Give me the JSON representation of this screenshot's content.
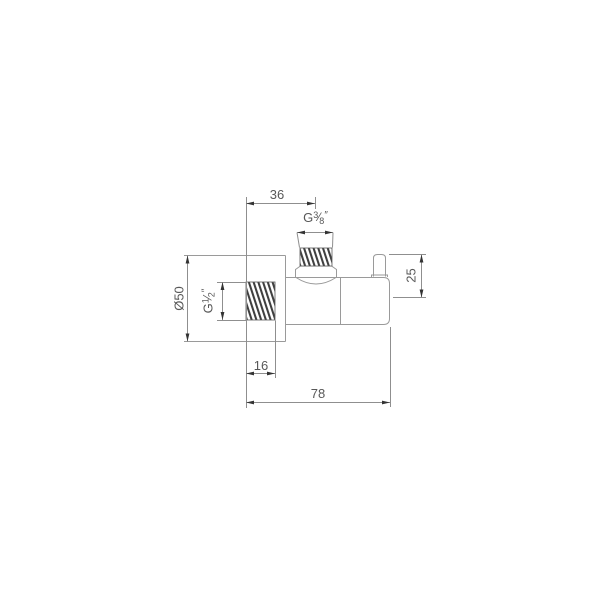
{
  "labels": {
    "dim_top_offset": "36",
    "dim_total_length": "78",
    "dim_thread_length": "16",
    "dim_handle_height": "25",
    "dim_flange_diameter": "Ø50",
    "thread_outlet": {
      "prefix": "G",
      "numerator": "3",
      "slash": "⁄",
      "denominator": "8",
      "suffix": "″"
    },
    "thread_inlet": {
      "prefix": "G",
      "numerator": "1",
      "slash": "⁄",
      "denominator": "2",
      "suffix": "″"
    }
  },
  "colors": {
    "background": "#ffffff",
    "line": "#8f8f8f",
    "object_line": "#9a9a9a",
    "text": "#585858",
    "arrow": "#333333",
    "thread_hatch": "#3f3f3f"
  }
}
